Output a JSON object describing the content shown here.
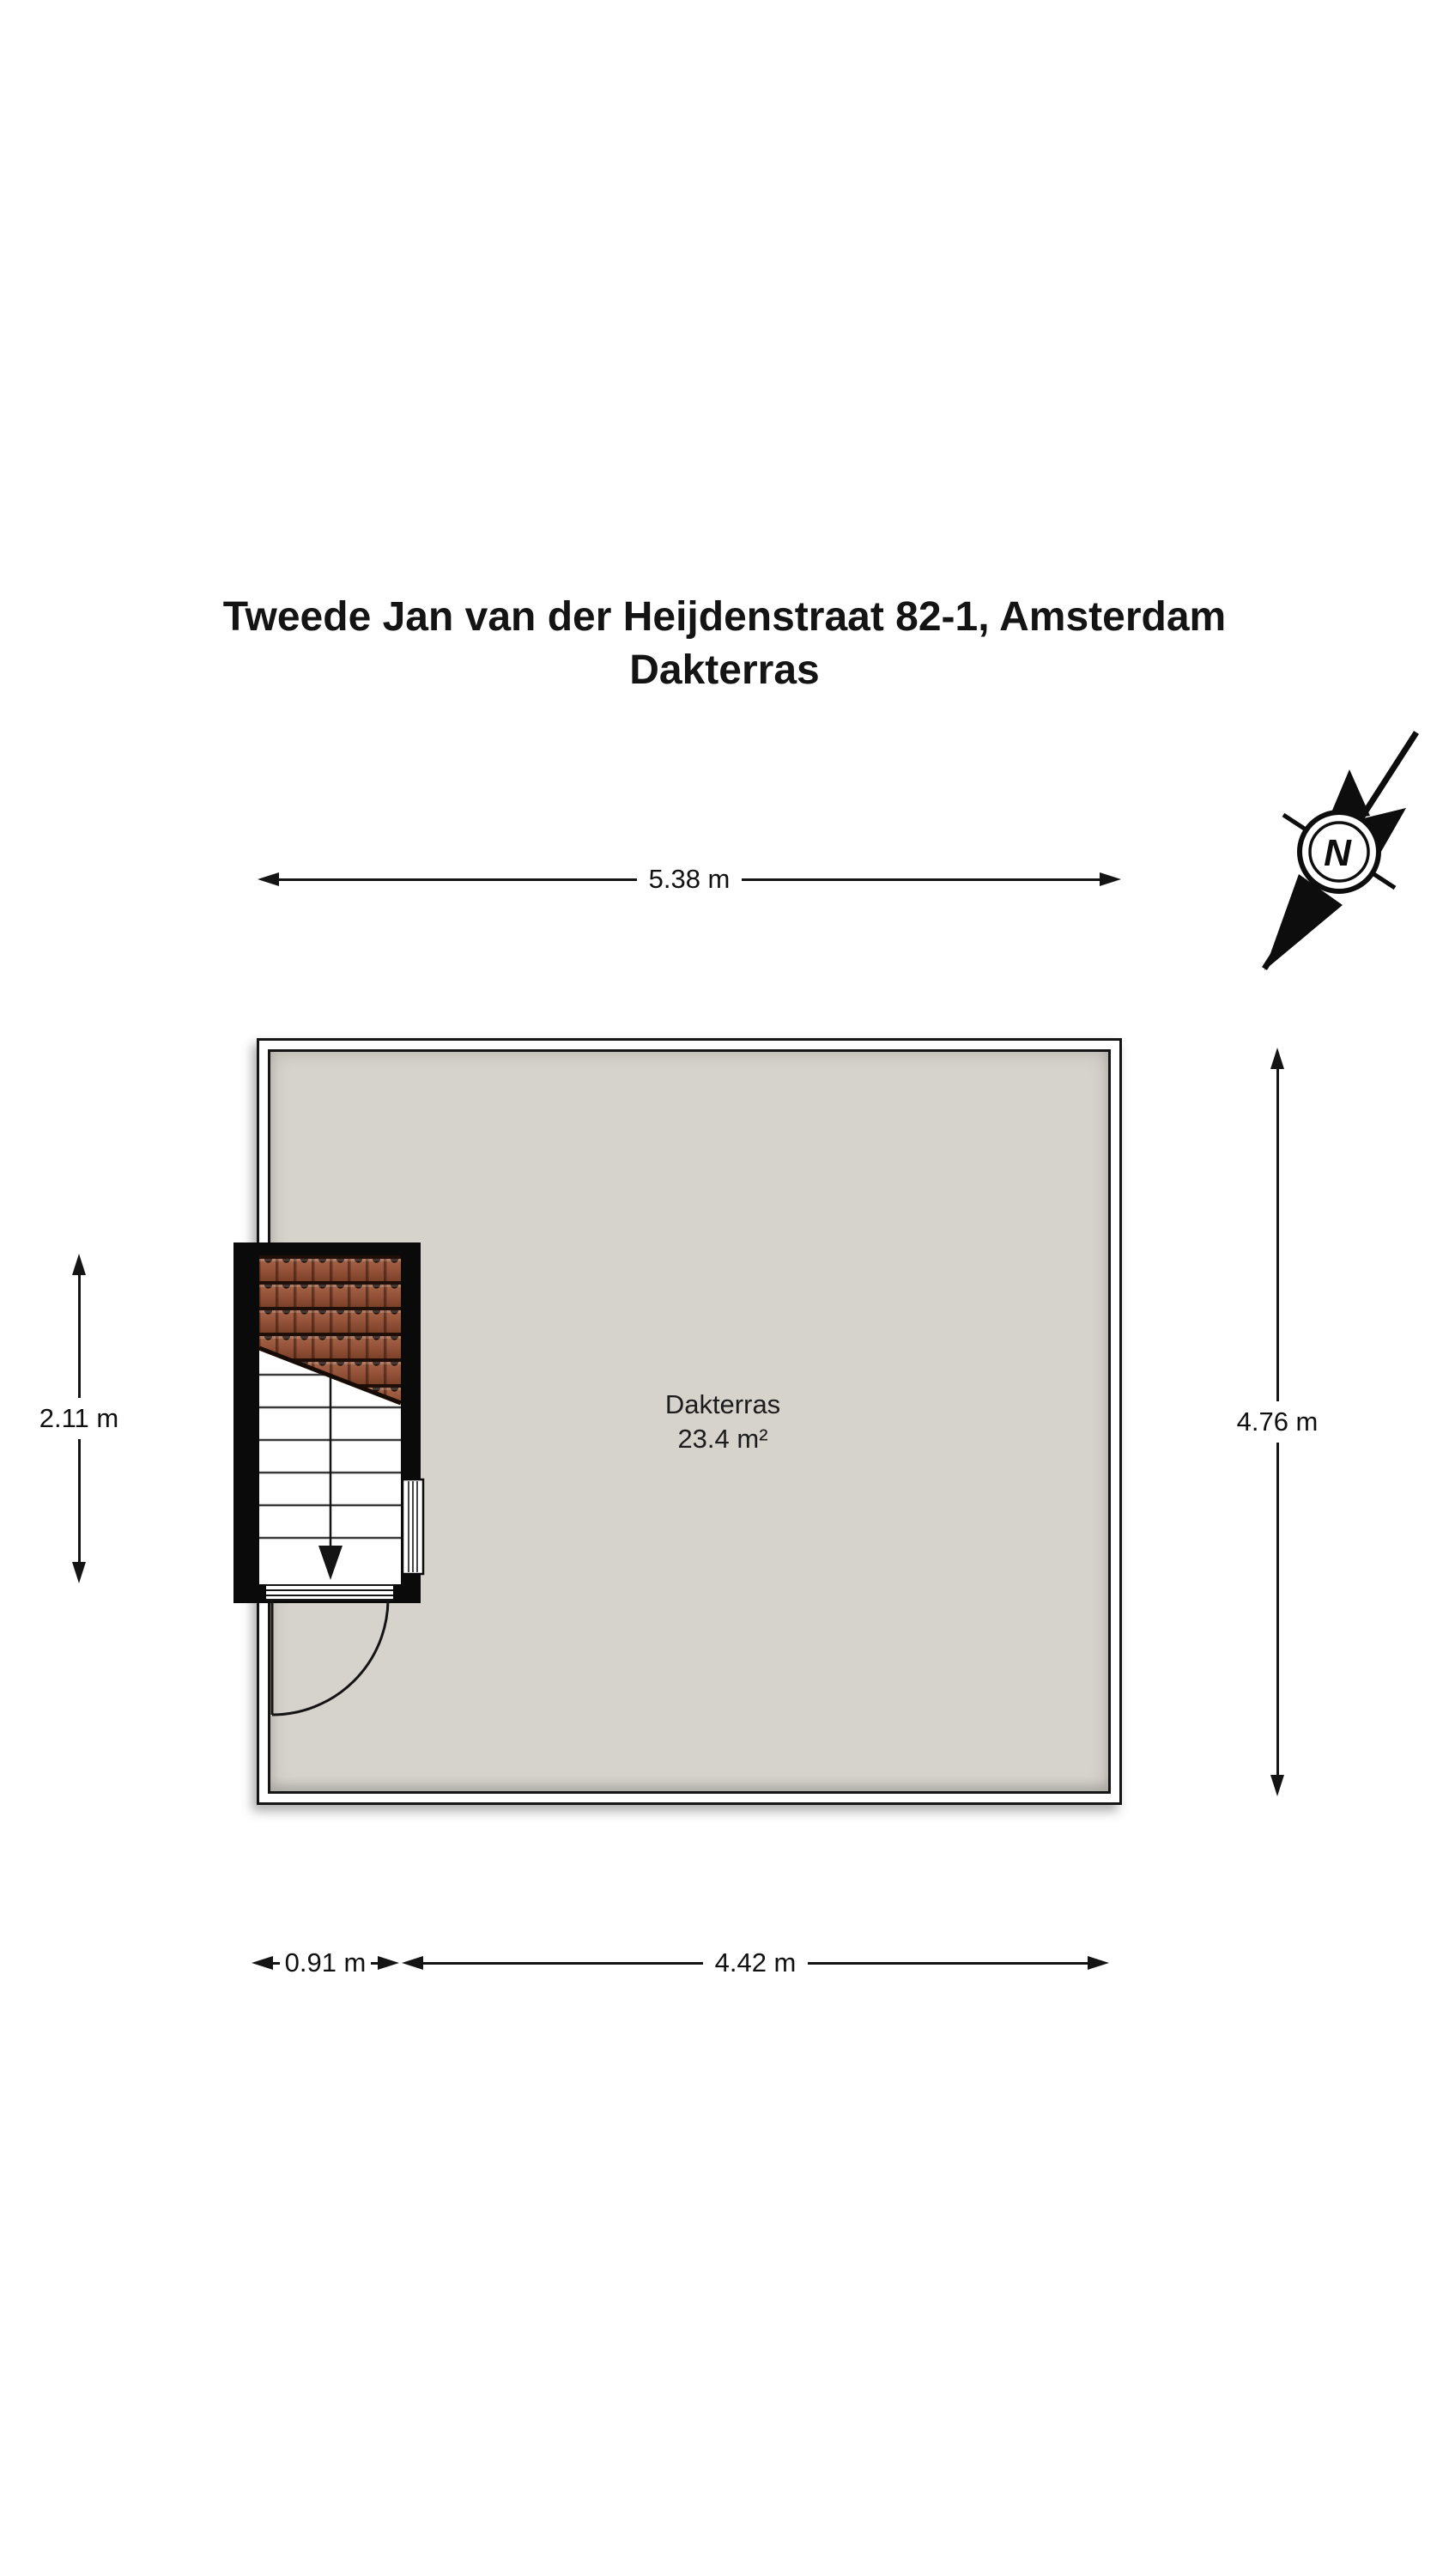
{
  "title": {
    "line1": "Tweede Jan van der Heijdenstraat 82-1, Amsterdam",
    "line2": "Dakterras"
  },
  "compass": {
    "letter": "N"
  },
  "room": {
    "name": "Dakterras",
    "area": "23.4 m²"
  },
  "dimensions": {
    "top": "5.38 m",
    "right": "4.76 m",
    "left": "2.11 m",
    "bottom_left": "0.91 m",
    "bottom_right": "4.42 m"
  },
  "colors": {
    "terrace_fill": "#d6d3cc",
    "roof_tile": "#95533a",
    "wall_black": "#0a0a0a",
    "ink": "#141414",
    "railing_white": "#ffffff"
  }
}
